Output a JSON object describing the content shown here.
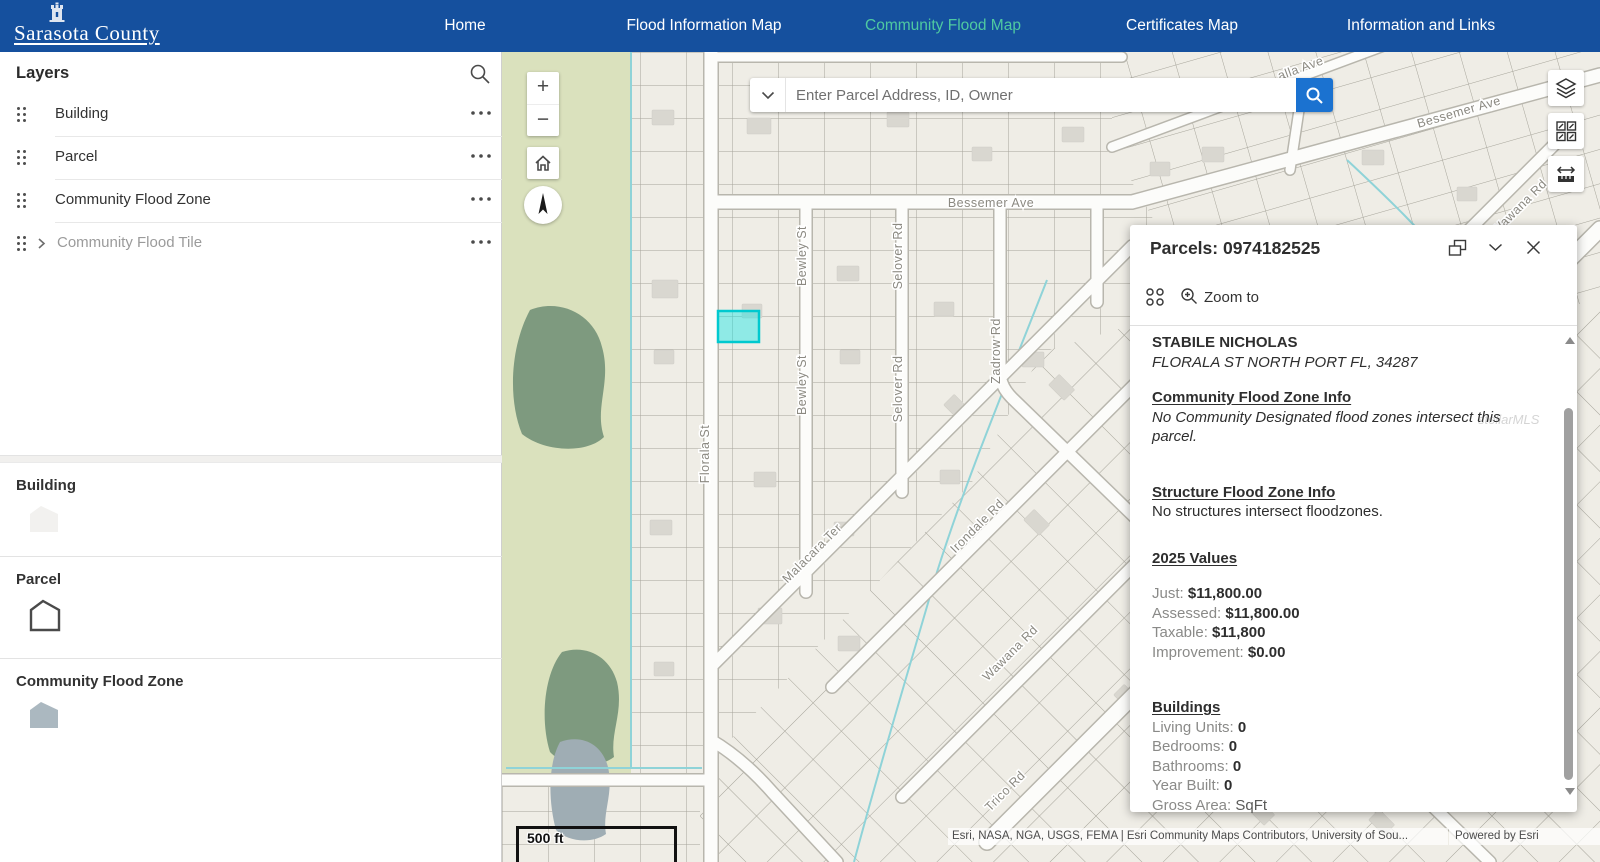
{
  "nav": {
    "brand": "Sarasota County",
    "items": [
      {
        "label": "Home"
      },
      {
        "label": "Flood Information Map"
      },
      {
        "label": "Community Flood Map"
      },
      {
        "label": "Certificates Map"
      },
      {
        "label": "Information and Links"
      }
    ],
    "active_index": 2,
    "colors": {
      "bar": "#15509E",
      "active_link": "#4FC9A1",
      "link": "#FFFFFF"
    }
  },
  "layers_panel": {
    "title": "Layers",
    "items": [
      {
        "label": "Building"
      },
      {
        "label": "Parcel"
      },
      {
        "label": "Community Flood Zone"
      },
      {
        "label": "Community Flood Tile"
      }
    ]
  },
  "legend": {
    "sections": [
      {
        "title": "Building",
        "swatch_color": "#F2F1EF",
        "swatch_style": "fill-light"
      },
      {
        "title": "Parcel",
        "swatch_color": "#FFFFFF",
        "swatch_style": "outline"
      },
      {
        "title": "Community Flood Zone",
        "swatch_color": "#ABB8C0",
        "swatch_style": "fill"
      }
    ]
  },
  "map_ui": {
    "search": {
      "placeholder": "Enter Parcel Address, ID, Owner",
      "button_color": "#1B72D0"
    },
    "scale_bar": "500 ft",
    "attribution": "Esri, NASA, NGA, USGS, FEMA | Esri Community Maps Contributors, University of Sou...",
    "powered_by": "Powered by Esri",
    "highlight_color": "#00C9CF",
    "street_labels": [
      {
        "text": "Bessemer Ave",
        "x": 489,
        "y": 155,
        "rot": 0
      },
      {
        "text": "Bessemer Ave",
        "x": 958,
        "y": 64,
        "rot": -16
      },
      {
        "text": "alla Ave",
        "x": 800,
        "y": 20,
        "rot": -20
      },
      {
        "text": "Florala St",
        "x": 207,
        "y": 402,
        "rot": -90
      },
      {
        "text": "Bewley St",
        "x": 304,
        "y": 204,
        "rot": -90
      },
      {
        "text": "Bewley St",
        "x": 304,
        "y": 333,
        "rot": -90
      },
      {
        "text": "Selover Rd",
        "x": 400,
        "y": 204,
        "rot": -90
      },
      {
        "text": "Selover Rd",
        "x": 400,
        "y": 337,
        "rot": -90
      },
      {
        "text": "Zadrow Rd",
        "x": 498,
        "y": 299,
        "rot": -90
      },
      {
        "text": "Malacara Ter",
        "x": 313,
        "y": 504,
        "rot": -45
      },
      {
        "text": "Irondale Rd",
        "x": 478,
        "y": 477,
        "rot": -45
      },
      {
        "text": "Wawana Rd",
        "x": 511,
        "y": 604,
        "rot": -45
      },
      {
        "text": "Wawana Rd",
        "x": 1020,
        "y": 158,
        "rot": -45
      },
      {
        "text": "Trico Rd",
        "x": 506,
        "y": 742,
        "rot": -45
      }
    ]
  },
  "popup": {
    "title": "Parcels: 0974182525",
    "zoom_to_label": "Zoom to",
    "owner_name": "STABILE NICHOLAS",
    "owner_address": "FLORALA ST NORTH PORT FL, 34287",
    "community_flood": {
      "heading": "Community Flood Zone Info",
      "body": "No Community Designated flood zones intersect this parcel."
    },
    "structure_flood": {
      "heading": "Structure Flood Zone Info",
      "body": "No structures intersect floodzones."
    },
    "values_2025": {
      "heading": "2025 Values",
      "rows": [
        {
          "label": "Just:",
          "value": "$11,800.00"
        },
        {
          "label": "Assessed:",
          "value": "$11,800.00"
        },
        {
          "label": "Taxable:",
          "value": "$11,800"
        },
        {
          "label": "Improvement:",
          "value": "$0.00"
        }
      ]
    },
    "buildings": {
      "heading": "Buildings",
      "rows": [
        {
          "label": "Living Units:",
          "value": "0"
        },
        {
          "label": "Bedrooms:",
          "value": "0"
        },
        {
          "label": "Bathrooms:",
          "value": "0"
        },
        {
          "label": "Year Built:",
          "value": "0"
        },
        {
          "label": "Gross Area:",
          "value": "SqFt"
        }
      ]
    },
    "watermark": "stellarMLS"
  }
}
